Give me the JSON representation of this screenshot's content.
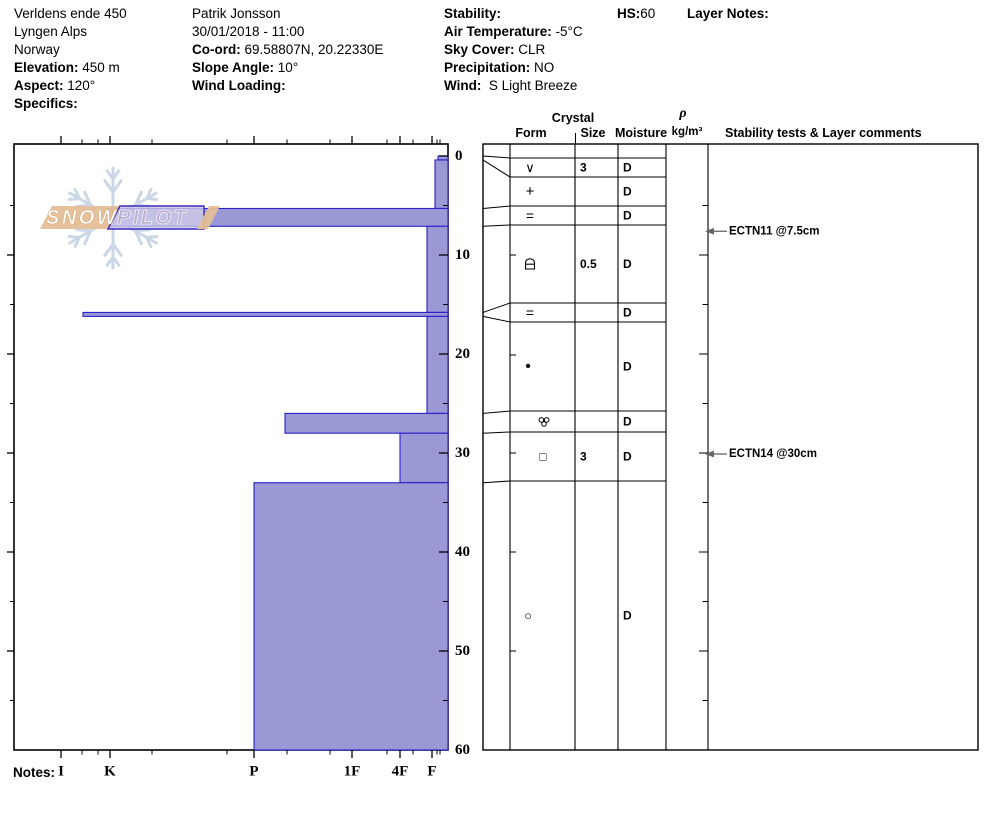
{
  "header": {
    "col1": [
      {
        "label": "",
        "value": "Verldens ende 450"
      },
      {
        "label": "",
        "value": "Lyngen Alps"
      },
      {
        "label": "",
        "value": "Norway"
      },
      {
        "label": "Elevation:",
        "value": "450 m"
      },
      {
        "label": "Aspect:",
        "value": "120°"
      },
      {
        "label": "Specifics:",
        "value": ""
      }
    ],
    "col2": [
      {
        "label": "",
        "value": "Patrik Jonsson"
      },
      {
        "label": "",
        "value": "30/01/2018 - 11:00"
      },
      {
        "label": "Co-ord:",
        "value": "69.58807N, 20.22330E"
      },
      {
        "label": "Slope Angle:",
        "value": "10°"
      },
      {
        "label": "Wind Loading:",
        "value": ""
      }
    ],
    "col3": [
      {
        "label": "Stability:",
        "value": ""
      },
      {
        "label": "Air Temperature:",
        "value": "-5°C"
      },
      {
        "label": "Sky Cover:",
        "value": "CLR"
      },
      {
        "label": "Precipitation:",
        "value": "NO"
      },
      {
        "label": "Wind:",
        "value": " S Light Breeze"
      }
    ],
    "hs_label": "HS:",
    "hs_value": "60",
    "layer_notes_label": "Layer Notes:"
  },
  "footer": {
    "notes_label": "Notes:"
  },
  "logo": {
    "word1": "SNOW",
    "word2": "PILOT",
    "snowflake": {
      "cx": 113,
      "cy": 218,
      "r": 50
    }
  },
  "colors": {
    "bar_fill": "#9a99d6",
    "bar_border": "#2a1fc8",
    "logo_tan": "#e4bf97",
    "logo_lavender": "#cdc9e7",
    "logo_lavender_border": "#382cc0",
    "snowflake": "#cbd7e6",
    "annotation_arrow": "#666666",
    "ink": "#000000"
  },
  "table": {
    "headers": {
      "crystal": "Crystal",
      "form": "Form",
      "size": "Size",
      "moisture": "Moisture",
      "rho_top": "ρ",
      "rho_bottom": "kg/m³",
      "comments": "Stability tests & Layer comments"
    },
    "left": 483,
    "funnel_right": 510,
    "col_dividers": [
      510,
      575,
      618,
      666,
      708
    ],
    "right": 978,
    "size_x": 580,
    "moisture_x": 623,
    "row_line_right": 666
  },
  "annotations": [
    {
      "label": "ECTN11 @7.5cm",
      "depth_cm": 7.5
    },
    {
      "label": "ECTN14 @30cm",
      "depth_cm": 30
    }
  ],
  "chart_data": {
    "type": "snow-profile-bar",
    "title": "SnowPilot hand-hardness profile with layer table",
    "depth_axis": {
      "unit": "cm",
      "min": 0,
      "max": 60,
      "ticks": [
        0,
        10,
        20,
        30,
        40,
        50,
        60
      ],
      "minor_step_cm": 5
    },
    "hardness_axis": {
      "categories": [
        "I",
        "K",
        "P",
        "1F",
        "4F",
        "F"
      ],
      "x_px": [
        61,
        110,
        254,
        352,
        400,
        432
      ],
      "minor_x_px": [
        82,
        98,
        152,
        227,
        287,
        330,
        387,
        413,
        437,
        440
      ]
    },
    "geometry": {
      "left": 14,
      "right": 448,
      "top": 144,
      "bottom": 750,
      "zero_y": 156,
      "px_per_cm": 9.9
    },
    "layers": [
      {
        "depth_top_cm": 0,
        "depth_bottom_cm": 0.4,
        "hardness": "F-",
        "bar_left_px": 438,
        "glyph": "v",
        "glyph_x": 530,
        "size": "3",
        "moisture": "D",
        "row": [
          158,
          177
        ]
      },
      {
        "depth_top_cm": 0.4,
        "depth_bottom_cm": 5.3,
        "hardness": "F",
        "bar_left_px": 435,
        "glyph": "plus",
        "glyph_x": 530,
        "size": "",
        "moisture": "D",
        "row": [
          177,
          206
        ]
      },
      {
        "depth_top_cm": 5.3,
        "depth_bottom_cm": 7.1,
        "hardness": "K",
        "bar_left_px": 108,
        "glyph": "equals",
        "glyph_x": 530,
        "size": "",
        "moisture": "D",
        "row": [
          206,
          225
        ]
      },
      {
        "depth_top_cm": 7.1,
        "depth_bottom_cm": 15.8,
        "hardness": "F+",
        "bar_left_px": 427,
        "glyph": "arch",
        "glyph_x": 530,
        "size": "0.5",
        "moisture": "D",
        "row": [
          225,
          303
        ]
      },
      {
        "depth_top_cm": 15.8,
        "depth_bottom_cm": 16.2,
        "hardness": "K+",
        "bar_left_px": 83,
        "glyph": "equals",
        "glyph_x": 530,
        "size": "",
        "moisture": "D",
        "row": [
          303,
          322
        ]
      },
      {
        "depth_top_cm": 16.2,
        "depth_bottom_cm": 26,
        "hardness": "F+",
        "bar_left_px": 427,
        "glyph": "dot",
        "glyph_x": 528,
        "size": "",
        "moisture": "D",
        "row": [
          322,
          411
        ]
      },
      {
        "depth_top_cm": 26,
        "depth_bottom_cm": 28,
        "hardness": "P-",
        "bar_left_px": 285,
        "glyph": "cluster",
        "glyph_x": 544,
        "size": "",
        "moisture": "D",
        "row": [
          411,
          432
        ]
      },
      {
        "depth_top_cm": 28,
        "depth_bottom_cm": 33,
        "hardness": "4F",
        "bar_left_px": 400,
        "glyph": "square",
        "glyph_x": 543,
        "size": "3",
        "moisture": "D",
        "row": [
          432,
          481
        ]
      },
      {
        "depth_top_cm": 33,
        "depth_bottom_cm": 60,
        "hardness": "P",
        "bar_left_px": 254,
        "glyph": "circle",
        "glyph_x": 528,
        "size": "",
        "moisture": "D",
        "row": [
          481,
          750
        ]
      }
    ]
  }
}
